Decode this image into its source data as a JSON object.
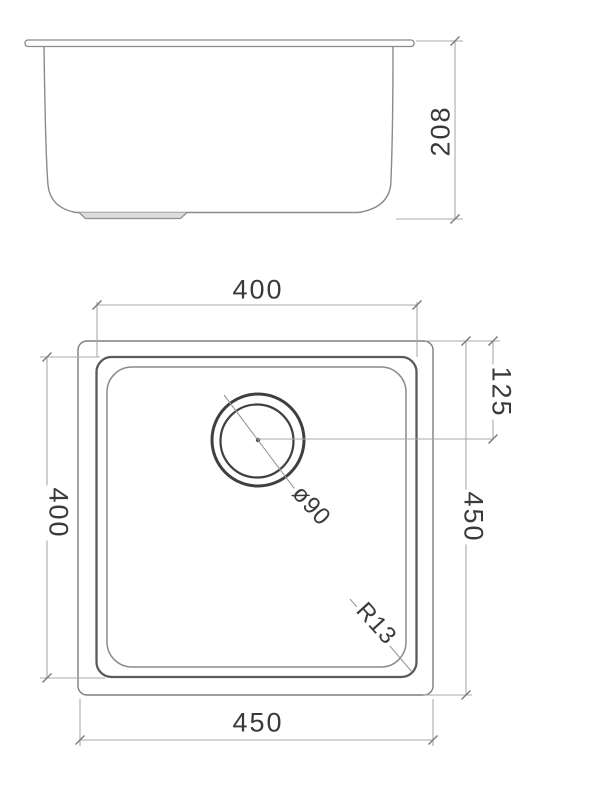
{
  "drawing": {
    "type": "technical-drawing",
    "subject": "undermount-sink",
    "side_view": {
      "depth": "208"
    },
    "plan_view": {
      "bowl_width_top": "400",
      "bowl_depth_left": "400",
      "overall_depth_right": "450",
      "overall_width_bottom": "450",
      "drain_center_offset": "125",
      "drain_diameter": "ø90",
      "corner_radius": "R13"
    },
    "colors": {
      "outline": "#8a8a8a",
      "bold_outline": "#4a4a4a",
      "dimension_line": "#a8a8a8",
      "text": "#3a3a3a"
    }
  }
}
